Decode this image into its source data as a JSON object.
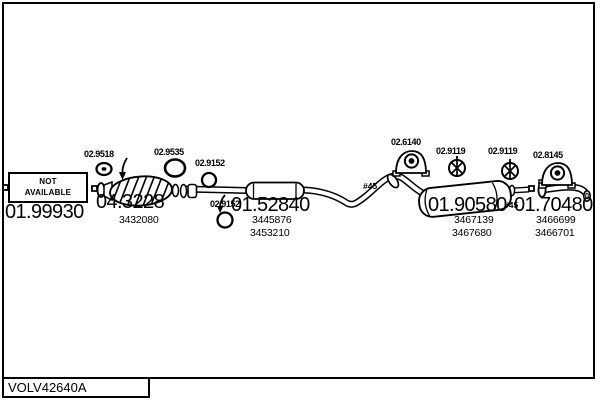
{
  "page": {
    "background": "#ffffff",
    "ink": "#000000"
  },
  "footer": {
    "drawing_code": "VOLV42640A"
  },
  "front_section": {
    "availability": {
      "line1": "NOT",
      "line2": "AVAILABLE"
    },
    "code": "01.99930"
  },
  "fittings": {
    "gasket_front": {
      "code": "02.9518"
    },
    "gasket_cat": {
      "code": "02.9535"
    },
    "clamp_a": {
      "code": "02.9152"
    },
    "clamp_b": {
      "code": "02.9152"
    },
    "bracket_mid": {
      "code": "02.6140"
    },
    "grommet_a": {
      "code": "02.9119"
    },
    "grommet_b": {
      "code": "02.9119"
    },
    "bracket_tail": {
      "code": "02.8145"
    }
  },
  "sections": {
    "catalytic": {
      "code": "04.3228",
      "oe1": "3432080"
    },
    "centre": {
      "code": "01.52840",
      "oe1": "3445876",
      "oe2": "3453210"
    },
    "rear": {
      "code": "01.90580",
      "oe1": "3467139",
      "oe2": "3467680"
    },
    "tail": {
      "code": "01.70480",
      "oe1": "3466699",
      "oe2": "3466701"
    }
  },
  "marks": {
    "diameter_a": "#45",
    "diameter_b": "#45"
  }
}
